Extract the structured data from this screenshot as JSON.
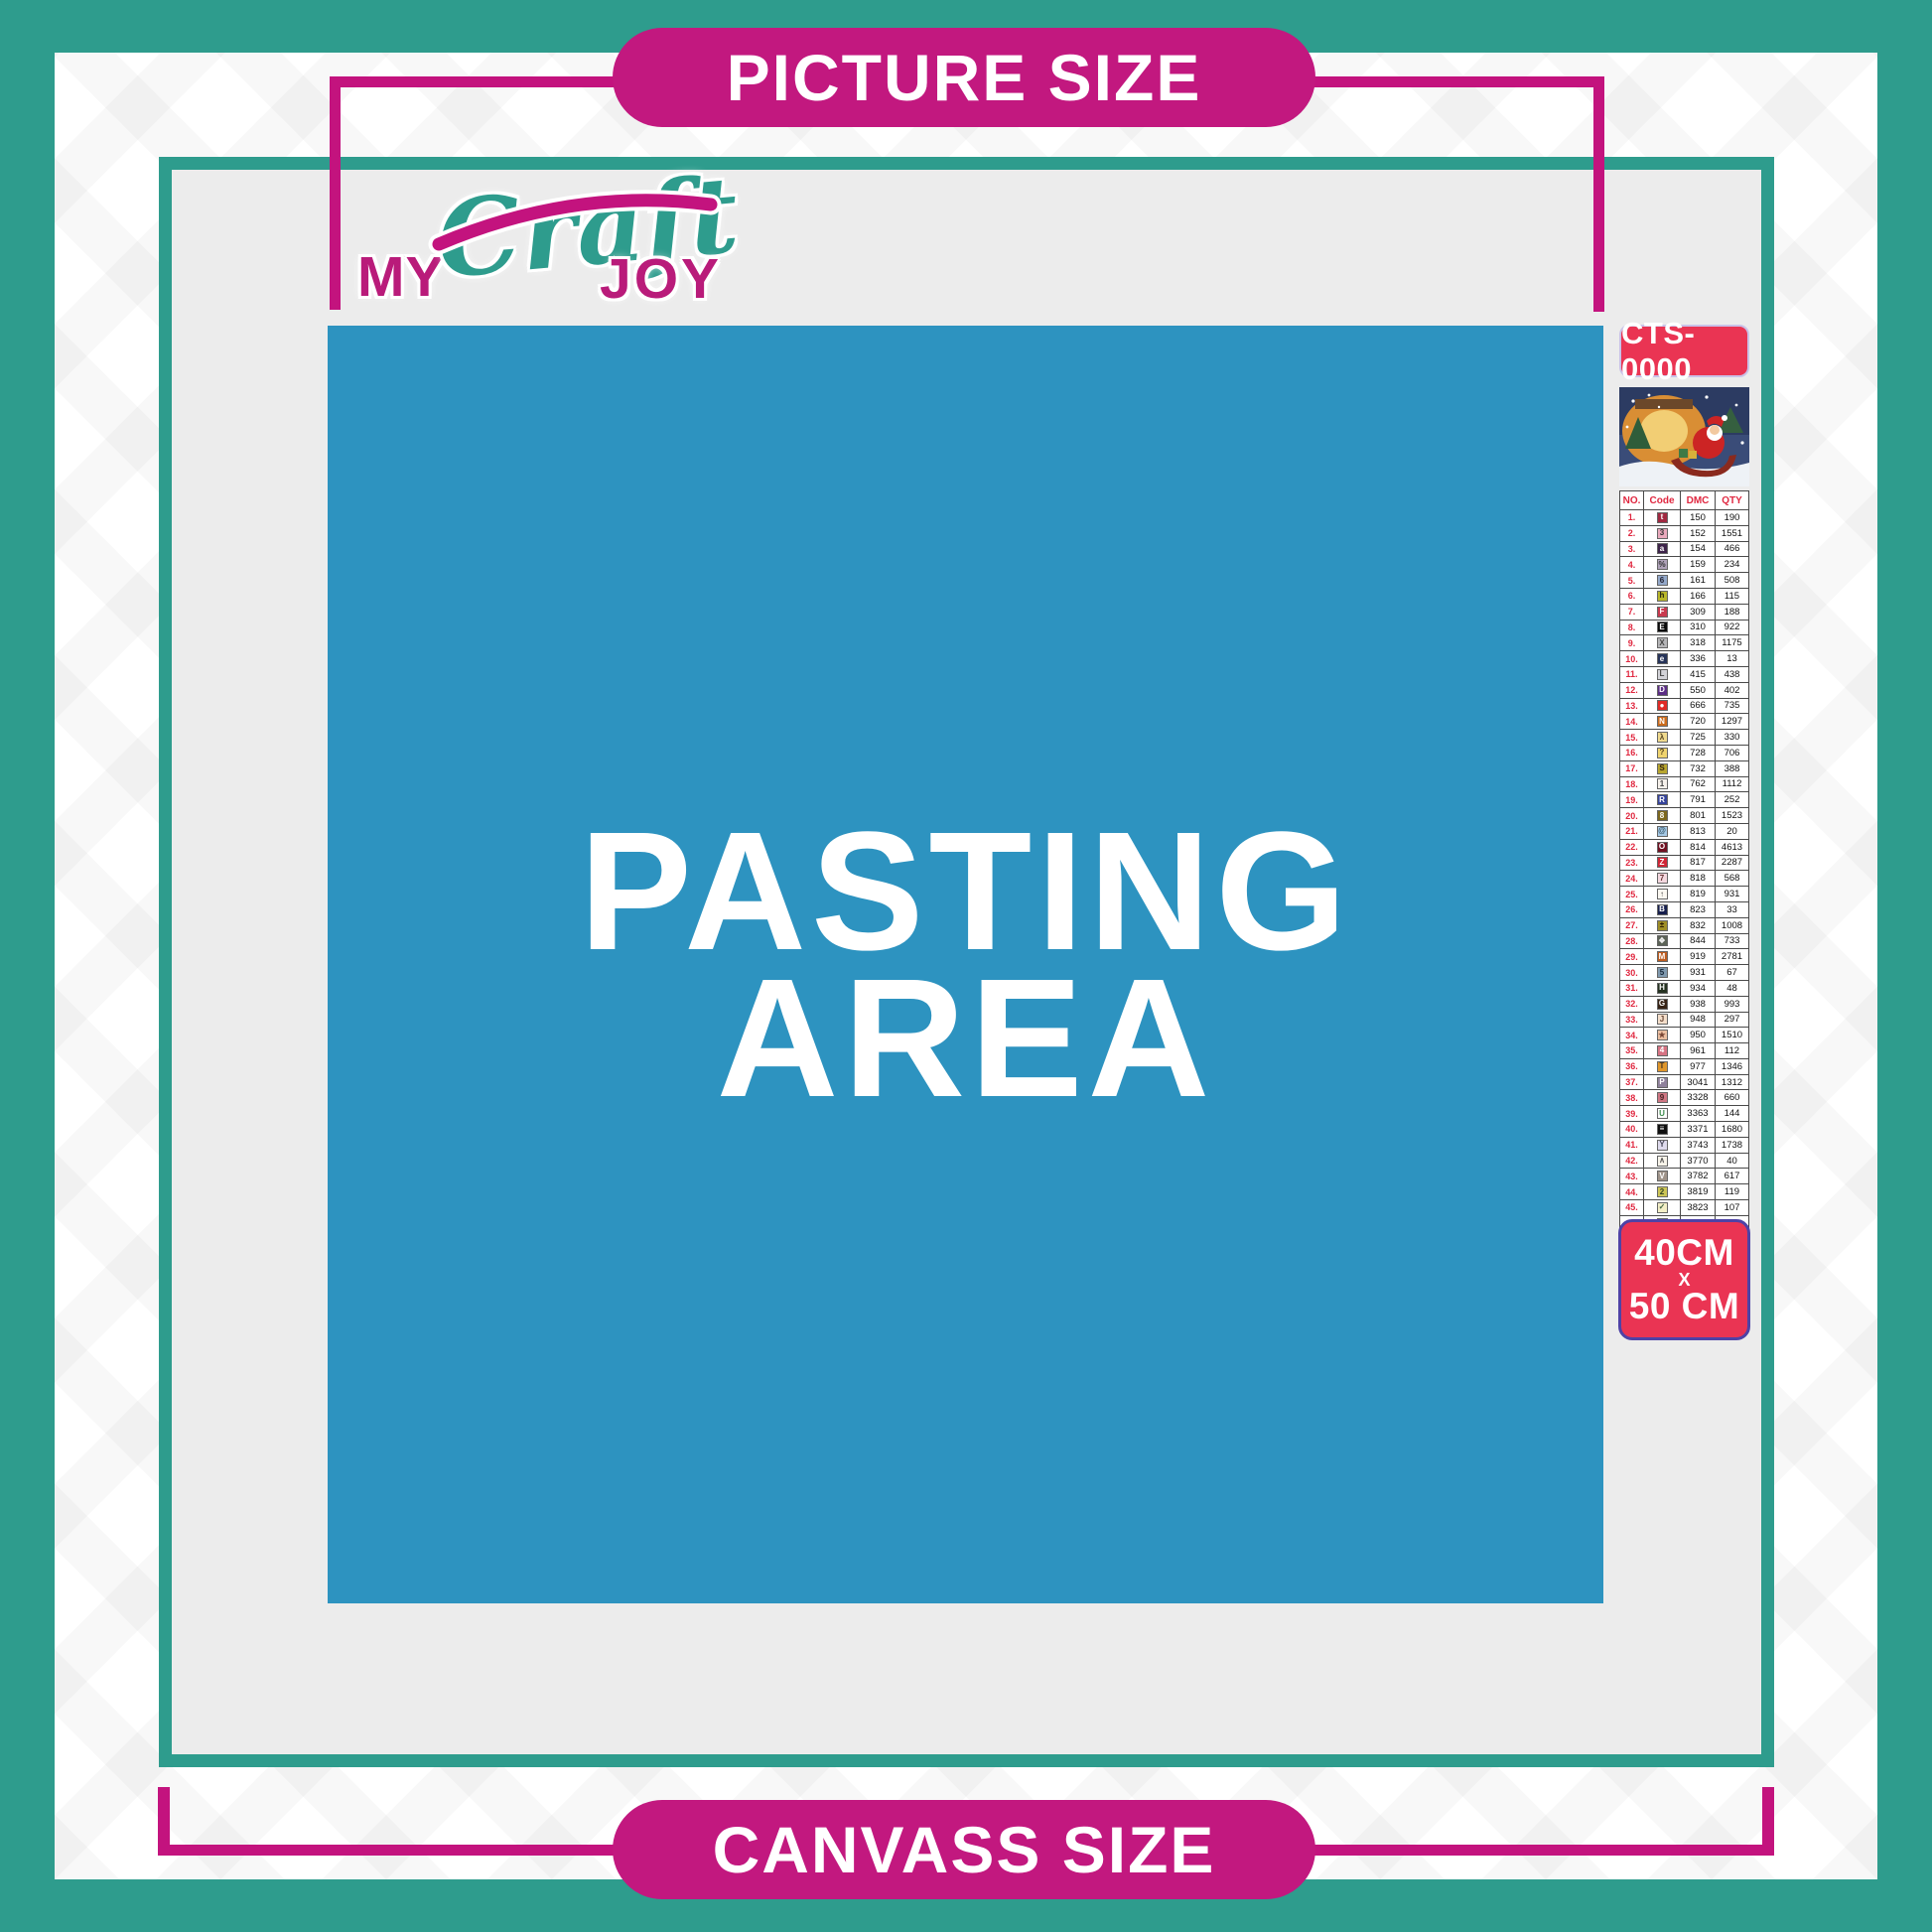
{
  "brand": {
    "my": "MY",
    "craft": "Craft",
    "joy": "JOY"
  },
  "labels": {
    "top": "PICTURE SIZE",
    "bottom": "CANVASS SIZE"
  },
  "pasting": {
    "line1": "PASTING",
    "line2": "AREA"
  },
  "product": {
    "code": "CTS-0000",
    "size_top": "40CM",
    "size_x": "X",
    "size_bottom": "50 CM"
  },
  "colors": {
    "teal": "#2E9C8D",
    "magenta_line": "#C3137E",
    "magenta_pill": "#C2187F",
    "blue_area": "#2D93C0",
    "red_label": "#EA3453",
    "interior_gray": "#ECECEC"
  },
  "legend": {
    "headers": [
      "NO.",
      "Code",
      "DMC",
      "QTY"
    ],
    "rows": [
      {
        "no": "1.",
        "sym": "t",
        "bg": "#A02840",
        "fg": "#FFFFFF",
        "dmc": "150",
        "qty": "190"
      },
      {
        "no": "2.",
        "sym": "3",
        "bg": "#E9A9BC",
        "fg": "#333333",
        "dmc": "152",
        "qty": "1551"
      },
      {
        "no": "3.",
        "sym": "a",
        "bg": "#3D2349",
        "fg": "#FFFFFF",
        "dmc": "154",
        "qty": "466"
      },
      {
        "no": "4.",
        "sym": "%",
        "bg": "#AFA2B9",
        "fg": "#333333",
        "dmc": "159",
        "qty": "234"
      },
      {
        "no": "5.",
        "sym": "6",
        "bg": "#93A8C9",
        "fg": "#222233",
        "dmc": "161",
        "qty": "508"
      },
      {
        "no": "6.",
        "sym": "h",
        "bg": "#B9B72B",
        "fg": "#222211",
        "dmc": "166",
        "qty": "115"
      },
      {
        "no": "7.",
        "sym": "F",
        "bg": "#C83A4E",
        "fg": "#FFFFFF",
        "dmc": "309",
        "qty": "188"
      },
      {
        "no": "8.",
        "sym": "E",
        "bg": "#0A0A0A",
        "fg": "#FFFFFF",
        "dmc": "310",
        "qty": "922"
      },
      {
        "no": "9.",
        "sym": "X",
        "bg": "#B5B5B7",
        "fg": "#444444",
        "dmc": "318",
        "qty": "1175"
      },
      {
        "no": "10.",
        "sym": "e",
        "bg": "#273459",
        "fg": "#FFFFFF",
        "dmc": "336",
        "qty": "13"
      },
      {
        "no": "11.",
        "sym": "L",
        "bg": "#D3D3D8",
        "fg": "#444444",
        "dmc": "415",
        "qty": "438"
      },
      {
        "no": "12.",
        "sym": "D",
        "bg": "#5C2E85",
        "fg": "#FFFFFF",
        "dmc": "550",
        "qty": "402"
      },
      {
        "no": "13.",
        "sym": "●",
        "bg": "#E02B26",
        "fg": "#FFFFFF",
        "dmc": "666",
        "qty": "735"
      },
      {
        "no": "14.",
        "sym": "N",
        "bg": "#CB6C1D",
        "fg": "#FFFFFF",
        "dmc": "720",
        "qty": "1297"
      },
      {
        "no": "15.",
        "sym": "λ",
        "bg": "#F0DA8E",
        "fg": "#554422",
        "dmc": "725",
        "qty": "330"
      },
      {
        "no": "16.",
        "sym": "?",
        "bg": "#F0D46F",
        "fg": "#554422",
        "dmc": "728",
        "qty": "706"
      },
      {
        "no": "17.",
        "sym": "S",
        "bg": "#B8A62F",
        "fg": "#332211",
        "dmc": "732",
        "qty": "388"
      },
      {
        "no": "18.",
        "sym": "1",
        "bg": "#F6F1EB",
        "fg": "#444444",
        "dmc": "762",
        "qty": "1112"
      },
      {
        "no": "19.",
        "sym": "R",
        "bg": "#35439A",
        "fg": "#FFFFFF",
        "dmc": "791",
        "qty": "252"
      },
      {
        "no": "20.",
        "sym": "8",
        "bg": "#7C671D",
        "fg": "#FFFFFF",
        "dmc": "801",
        "qty": "1523"
      },
      {
        "no": "21.",
        "sym": "@",
        "bg": "#A6C9E6",
        "fg": "#335566",
        "dmc": "813",
        "qty": "20"
      },
      {
        "no": "22.",
        "sym": "O",
        "bg": "#701021",
        "fg": "#FFFFFF",
        "dmc": "814",
        "qty": "4613"
      },
      {
        "no": "23.",
        "sym": "Z",
        "bg": "#D02535",
        "fg": "#FFFFFF",
        "dmc": "817",
        "qty": "2287"
      },
      {
        "no": "24.",
        "sym": "7",
        "bg": "#F4D8DF",
        "fg": "#663333",
        "dmc": "818",
        "qty": "568"
      },
      {
        "no": "25.",
        "sym": "↑",
        "bg": "#FBF8F1",
        "fg": "#444444",
        "dmc": "819",
        "qty": "931"
      },
      {
        "no": "26.",
        "sym": "B",
        "bg": "#171F4D",
        "fg": "#FFFFFF",
        "dmc": "823",
        "qty": "33"
      },
      {
        "no": "27.",
        "sym": "±",
        "bg": "#9F8E26",
        "fg": "#221100",
        "dmc": "832",
        "qty": "1008"
      },
      {
        "no": "28.",
        "sym": "❖",
        "bg": "#5C6357",
        "fg": "#EEEEEE",
        "dmc": "844",
        "qty": "733"
      },
      {
        "no": "29.",
        "sym": "M",
        "bg": "#BE5D20",
        "fg": "#FFFFFF",
        "dmc": "919",
        "qty": "2781"
      },
      {
        "no": "30.",
        "sym": "5",
        "bg": "#8099AE",
        "fg": "#112233",
        "dmc": "931",
        "qty": "67"
      },
      {
        "no": "31.",
        "sym": "H",
        "bg": "#253221",
        "fg": "#FFFFFF",
        "dmc": "934",
        "qty": "48"
      },
      {
        "no": "32.",
        "sym": "G",
        "bg": "#362214",
        "fg": "#FFFFFF",
        "dmc": "938",
        "qty": "993"
      },
      {
        "no": "33.",
        "sym": "J",
        "bg": "#F4DECA",
        "fg": "#664433",
        "dmc": "948",
        "qty": "297"
      },
      {
        "no": "34.",
        "sym": "★",
        "bg": "#EBBFA1",
        "fg": "#774433",
        "dmc": "950",
        "qty": "1510"
      },
      {
        "no": "35.",
        "sym": "4",
        "bg": "#D67383",
        "fg": "#FFFFFF",
        "dmc": "961",
        "qty": "112"
      },
      {
        "no": "36.",
        "sym": "T",
        "bg": "#DF962B",
        "fg": "#443322",
        "dmc": "977",
        "qty": "1346"
      },
      {
        "no": "37.",
        "sym": "P",
        "bg": "#8F819B",
        "fg": "#FFFFFF",
        "dmc": "3041",
        "qty": "1312"
      },
      {
        "no": "38.",
        "sym": "9",
        "bg": "#CF7683",
        "fg": "#442222",
        "dmc": "3328",
        "qty": "660"
      },
      {
        "no": "39.",
        "sym": "U",
        "bg": "#FDFDFD",
        "fg": "#3A8A4A",
        "dmc": "3363",
        "qty": "144"
      },
      {
        "no": "40.",
        "sym": "≡",
        "bg": "#101010",
        "fg": "#FFFFFF",
        "dmc": "3371",
        "qty": "1680"
      },
      {
        "no": "41.",
        "sym": "Y",
        "bg": "#DEDAEC",
        "fg": "#444455",
        "dmc": "3743",
        "qty": "1738"
      },
      {
        "no": "42.",
        "sym": "∧",
        "bg": "#F8F4EA",
        "fg": "#555555",
        "dmc": "3770",
        "qty": "40"
      },
      {
        "no": "43.",
        "sym": "V",
        "bg": "#9F9389",
        "fg": "#FFFFFF",
        "dmc": "3782",
        "qty": "617"
      },
      {
        "no": "44.",
        "sym": "2",
        "bg": "#CDC556",
        "fg": "#334422",
        "dmc": "3819",
        "qty": "119"
      },
      {
        "no": "45.",
        "sym": "✓",
        "bg": "#F3EEC6",
        "fg": "#446644",
        "dmc": "3823",
        "qty": "107"
      },
      {
        "no": "46.",
        "sym": "C",
        "bg": "#E79F35",
        "fg": "#FFFFFF",
        "dmc": "3853",
        "qty": "1332"
      },
      {
        "no": "47.",
        "sym": "K",
        "bg": "#7F372C",
        "fg": "#FFFFFF",
        "dmc": "3858",
        "qty": "2311"
      },
      {
        "no": "48.",
        "sym": "A",
        "bg": "#B5A491",
        "fg": "#FFFFFF",
        "dmc": "3863",
        "qty": "1820"
      }
    ]
  }
}
